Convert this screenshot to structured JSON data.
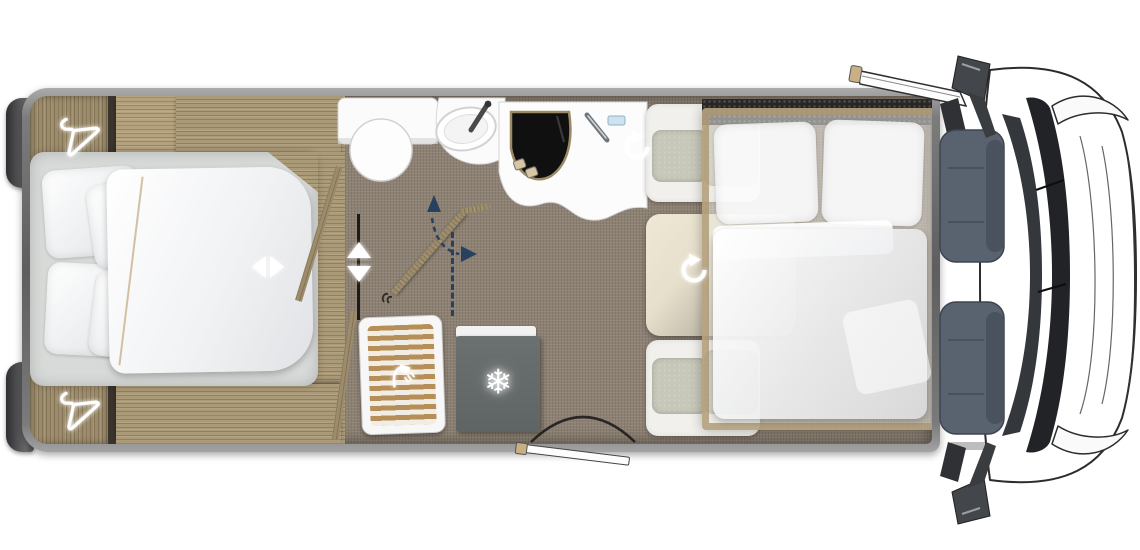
{
  "meta": {
    "view": "motorhome-floorplan-top-down"
  },
  "colors": {
    "wall": "#5e5e5e",
    "bumper": "#4b4b4d",
    "wood": "#ab9a78",
    "woodDark": "#9c8c6c",
    "floorWood": "#b0a184",
    "carpet": "#8d8173",
    "platform": "#d8dad9",
    "bedding": "#f4f5f6",
    "cushion": "#c7c8b9",
    "cushionDark": "#b5b7a7",
    "table": "#e7e1d0",
    "fridge": "#5f6464",
    "hob": "#101010",
    "hobTrim": "#9b8a63",
    "navy": "#27415f",
    "cabSeat": "#59626f",
    "dash": "#34383d",
    "lineArt": "#2c2c2c",
    "overlayFrame": "#ac9971",
    "slatWood": "#b68e58"
  },
  "icons": {
    "wardrobe_top": "hanger-icon",
    "wardrobe_bottom": "hanger-icon",
    "bed_extend": "left-right-arrows-icon",
    "sliding_door": "up-down-arrows-icon",
    "bathroom_door_swing": "dashed-swing-arrows-icon",
    "seat_swivel": "rotate-arrow-icon",
    "table_swivel": "rotate-arrow-icon",
    "fridge": "snowflake-icon",
    "fridge_glyph": "❄",
    "shower": "shower-head-icon",
    "entry_door": "door-swing-arc"
  },
  "floorplan": {
    "rooms": [
      {
        "name": "rear-bedroom",
        "furniture": [
          "double-bed",
          "wardrobe",
          "wardrobe",
          "bed-platform"
        ]
      },
      {
        "name": "washroom",
        "furniture": [
          "toilet",
          "washbasin",
          "swing-door",
          "shower"
        ]
      },
      {
        "name": "kitchen",
        "furniture": [
          "hob-sink-combo",
          "counter",
          "fridge-freezer"
        ]
      },
      {
        "name": "lounge",
        "furniture": [
          "bench-seat",
          "table",
          "bench-seat",
          "drop-down-bed"
        ]
      },
      {
        "name": "cab",
        "furniture": [
          "driver-seat",
          "passenger-seat",
          "dashboard",
          "mirrors",
          "open-door"
        ]
      }
    ]
  }
}
